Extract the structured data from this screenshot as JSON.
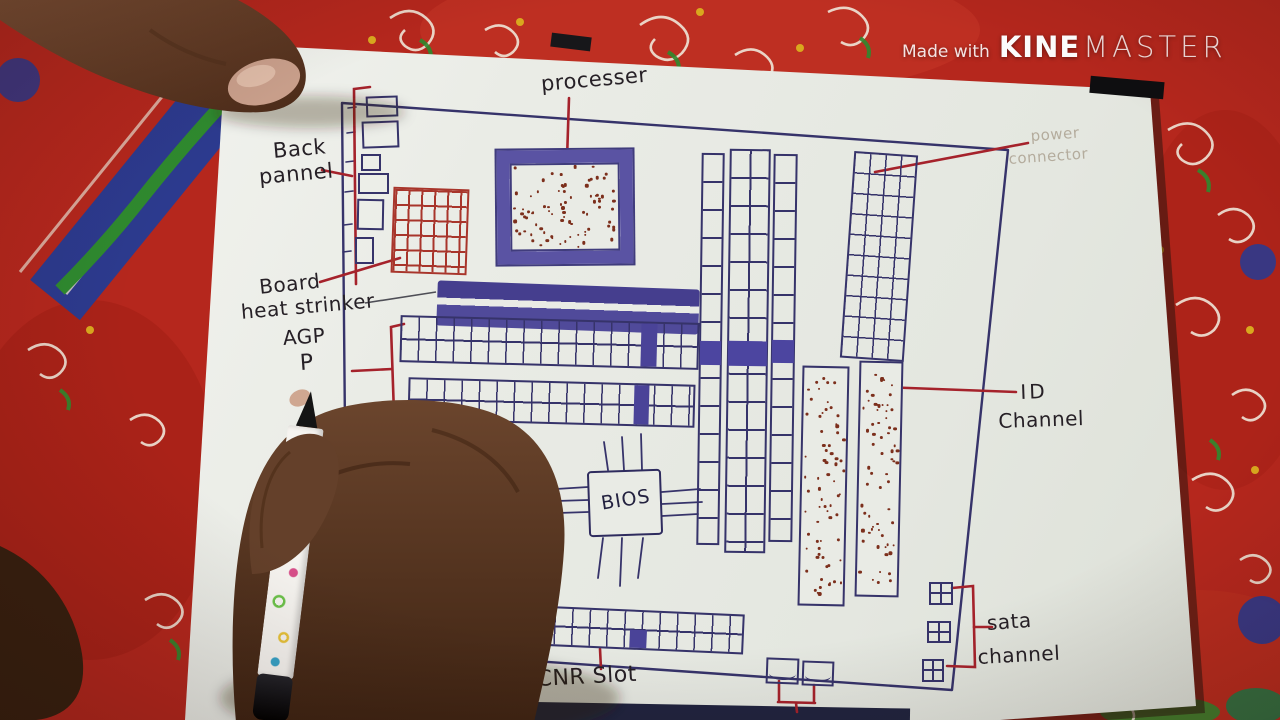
{
  "watermark": {
    "prefix": "Made with",
    "brand_bold": "KINE",
    "brand_light": "MASTER"
  },
  "labels": {
    "processor": "processer",
    "back_panel_line1": "Back",
    "back_panel_line2": "pannel",
    "board": "Board",
    "heat_sink": "heat strinker",
    "agp": "AGP",
    "pci_partial": "P",
    "bios": "BIOS",
    "cnr_slot": "CNR Slot",
    "id_channel_line1": "ID",
    "id_channel_line2": "Channel",
    "sata_line1": "sata",
    "sata_line2": "channel",
    "power_pencil_line1": "power",
    "power_pencil_line2": "connector"
  },
  "colors": {
    "cloth_red": "#b5271d",
    "ink_blue": "#36336a",
    "ink_red": "#a5222b",
    "label_ink": "#262026",
    "pencil_gray": "#b4ac9d",
    "slot_fill": "#4a4398",
    "dot_brown": "#7c2f1c",
    "bottom_strip_navy": "#20243f"
  }
}
